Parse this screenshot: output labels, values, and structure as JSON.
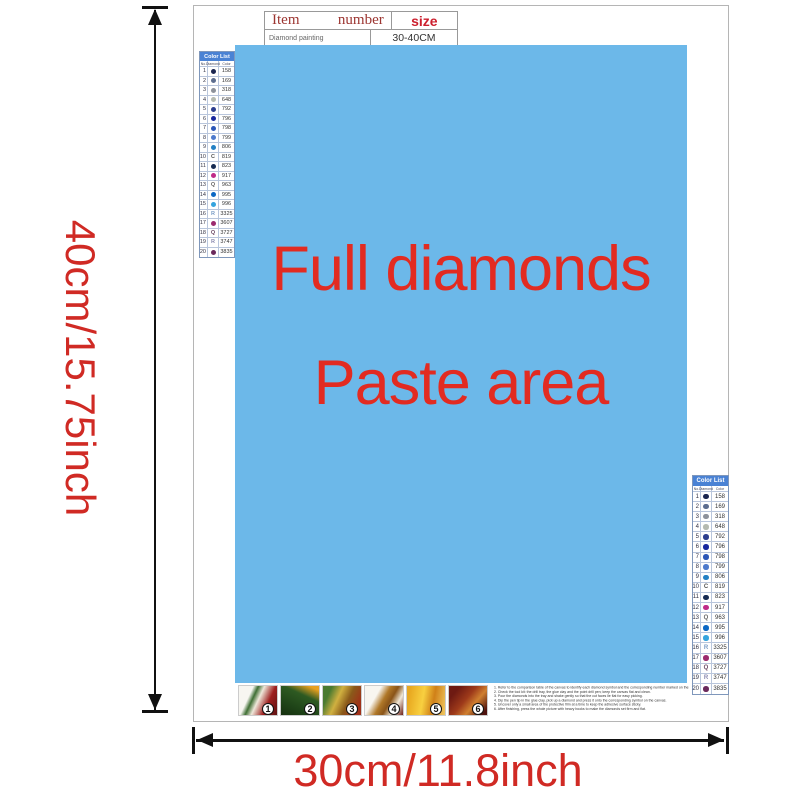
{
  "info_table": {
    "header": {
      "item": "Item",
      "number": "number",
      "size": "size"
    },
    "row": {
      "item": "Diamond painting",
      "number": "",
      "size": "30-40CM"
    }
  },
  "paste_area": {
    "line1": "Full diamonds",
    "line2": "Paste area",
    "bg_color": "#6cb8e9",
    "text_color": "#e22b21"
  },
  "color_list": {
    "title": "Color List",
    "columns": [
      "No.",
      "Diamond",
      "Color"
    ],
    "rows": [
      {
        "no": "1",
        "sym": "dot",
        "sym_color": "#1a2550",
        "code": "158"
      },
      {
        "no": "2",
        "sym": "dot",
        "sym_color": "#5c6d8f",
        "code": "169"
      },
      {
        "no": "3",
        "sym": "dot",
        "sym_color": "#8d929b",
        "code": "318"
      },
      {
        "no": "4",
        "sym": "dot",
        "sym_color": "#b5bab0",
        "code": "648"
      },
      {
        "no": "5",
        "sym": "dot",
        "sym_color": "#2c3e8f",
        "code": "792"
      },
      {
        "no": "6",
        "sym": "dot",
        "sym_color": "#17279e",
        "code": "796"
      },
      {
        "no": "7",
        "sym": "dot",
        "sym_color": "#2b57b8",
        "code": "798"
      },
      {
        "no": "8",
        "sym": "dot",
        "sym_color": "#4d7acc",
        "code": "799"
      },
      {
        "no": "9",
        "sym": "dot",
        "sym_color": "#2380c4",
        "code": "806"
      },
      {
        "no": "10",
        "sym": "C",
        "sym_color": "#555555",
        "code": "819"
      },
      {
        "no": "11",
        "sym": "dot",
        "sym_color": "#152a52",
        "code": "823"
      },
      {
        "no": "12",
        "sym": "dot",
        "sym_color": "#bf2a88",
        "code": "917"
      },
      {
        "no": "13",
        "sym": "Q",
        "sym_color": "#666666",
        "code": "963"
      },
      {
        "no": "14",
        "sym": "dot",
        "sym_color": "#0b67c4",
        "code": "995"
      },
      {
        "no": "15",
        "sym": "dot",
        "sym_color": "#35a4de",
        "code": "996"
      },
      {
        "no": "16",
        "sym": "R",
        "sym_color": "#7a9cc6",
        "code": "3325"
      },
      {
        "no": "17",
        "sym": "dot",
        "sym_color": "#9c2b6e",
        "code": "3607"
      },
      {
        "no": "18",
        "sym": "Q",
        "sym_color": "#6c4a66",
        "code": "3727"
      },
      {
        "no": "19",
        "sym": "R",
        "sym_color": "#8a8ab0",
        "code": "3747"
      },
      {
        "no": "20",
        "sym": "dot",
        "sym_color": "#6b2a5c",
        "code": "3835"
      }
    ]
  },
  "steps": [
    {
      "label": "1"
    },
    {
      "label": "2"
    },
    {
      "label": "3"
    },
    {
      "label": "4"
    },
    {
      "label": "5"
    },
    {
      "label": "6"
    }
  ],
  "instructions": {
    "lines": [
      "1. Refer to the comparison table of the canvas to identify each diamond symbol and the corresponding number marked on the canvas.",
      "2. Check the tool kit: the drill tray, the glue clay and the point drill pen; keep the canvas flat and clean.",
      "3. Pour the diamonds into the tray and shake gently so that the cut faces lie flat for easy picking.",
      "4. Dip the pen tip in the glue clay, pick up a diamond and press it onto the corresponding symbol on the canvas.",
      "5. Uncover only a small area of the protective film at a time to keep the adhesive surface sticky.",
      "6. After finishing, press the whole picture with heavy books to make the diamonds set firm and flat."
    ]
  },
  "dimensions": {
    "height_label": "40cm/15.75inch",
    "width_label": "30cm/11.8inch"
  }
}
